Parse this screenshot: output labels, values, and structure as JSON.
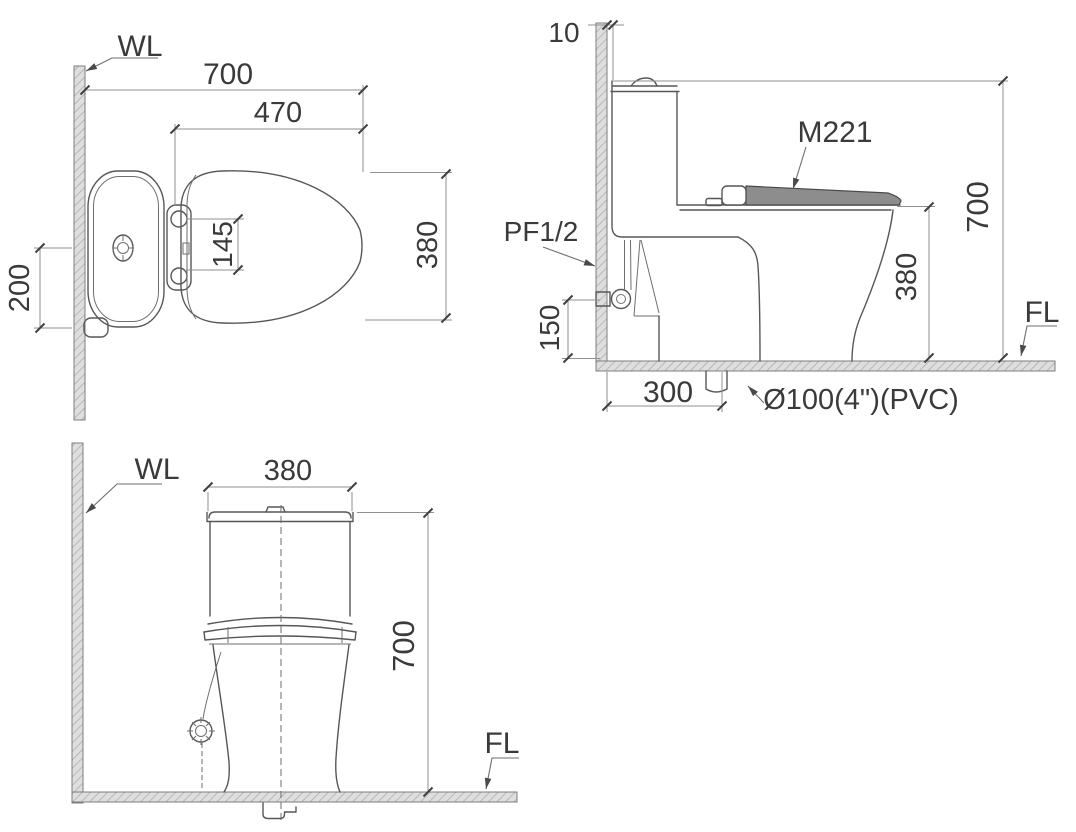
{
  "drawing": {
    "description": "Toilet installation dimension drawing, three orthographic views",
    "palette": {
      "object_line": "#575757",
      "dimension_line": "#8f8f8f",
      "text": "#3a3a3a",
      "hatch_fill": "#dedede",
      "hatch_line": "#a8a8a8",
      "background": "#ffffff"
    },
    "top_view": {
      "wall_label": "WL",
      "dim_overall_depth": "700",
      "dim_seat_length": "470",
      "dim_seat_width": "380",
      "dim_hinge_spacing": "145",
      "dim_supply_offset": "200"
    },
    "side_view": {
      "dim_wall_gap": "10",
      "seat_model_label": "M221",
      "supply_label": "PF1/2",
      "dim_overall_height": "700",
      "dim_rim_height": "380",
      "dim_supply_height": "150",
      "dim_drain_offset": "300",
      "drain_label": "Ø100(4\")(PVC)",
      "floor_label": "FL"
    },
    "front_view": {
      "wall_label": "WL",
      "dim_tank_width": "380",
      "dim_overall_height": "700",
      "floor_label": "FL"
    }
  }
}
